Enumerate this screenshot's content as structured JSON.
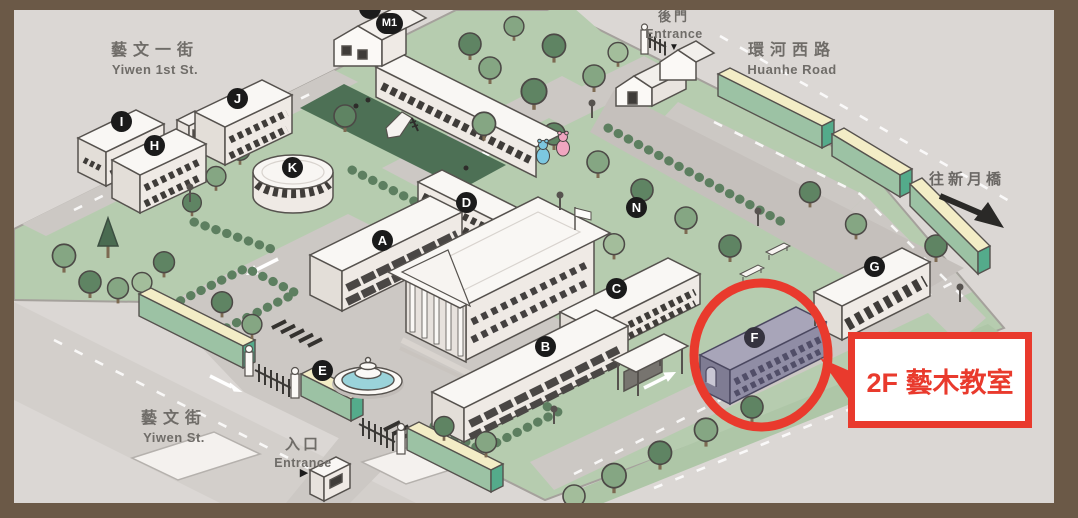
{
  "streets": {
    "yiwen1st": {
      "zh": "藝文一街",
      "en": "Yiwen 1st St."
    },
    "huanhe": {
      "zh": "環河西路",
      "en": "Huanhe Road"
    },
    "yiwen": {
      "zh": "藝文街",
      "en": "Yiwen St."
    }
  },
  "entrances": {
    "back": {
      "zh": "後門",
      "en": "Entrance",
      "marker": "▼"
    },
    "main": {
      "zh": "入口",
      "en": "Entrance",
      "marker": "▶"
    }
  },
  "bridge": {
    "label": "往新月橋",
    "arrow_direction": "southeast"
  },
  "buildings": [
    {
      "label": "A"
    },
    {
      "label": "B"
    },
    {
      "label": "C"
    },
    {
      "label": "D"
    },
    {
      "label": "E"
    },
    {
      "label": "F",
      "highlighted": true
    },
    {
      "label": "G"
    },
    {
      "label": "H"
    },
    {
      "label": "I"
    },
    {
      "label": "J"
    },
    {
      "label": "K"
    },
    {
      "label": "M1"
    },
    {
      "label": "N"
    }
  ],
  "callout": {
    "text": "2F 藝木教室",
    "target_building": "F"
  },
  "colors": {
    "accent_red": "#e93a2d",
    "frame_brown": "#6b5947",
    "street_gray": "#dbd7d4",
    "campus_green": "#b6ccaf",
    "plaza_gray": "#ccc8c4",
    "highlight_building_purple": "#908da5",
    "wall_green": "#9cc2a4",
    "wall_top_cream": "#f3edc6",
    "water_blue": "#9ad3da",
    "playground_green": "#4d7055"
  }
}
